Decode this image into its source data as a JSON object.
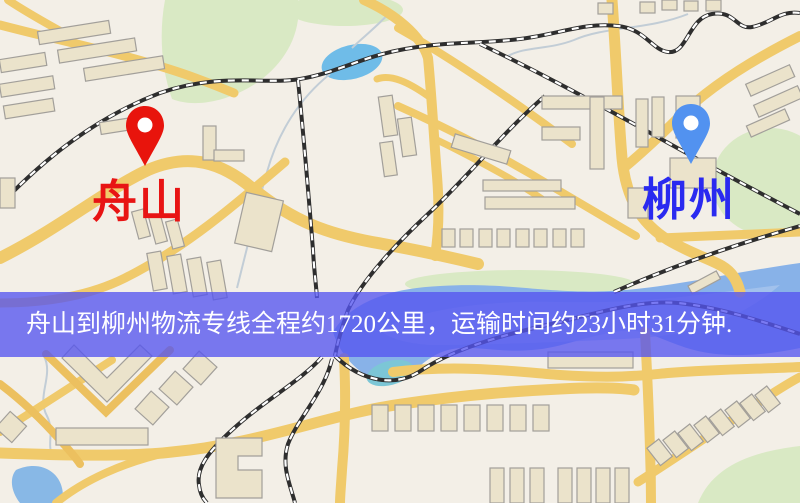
{
  "banner": {
    "text": "舟山到柳州物流专线全程约1720公里，运输时间约23小时31分钟.",
    "background_color": "#5555f0",
    "text_color": "#ffffff"
  },
  "route": {
    "origin": "舟山",
    "destination": "柳州",
    "distance_km": "1720",
    "duration_hours": "23",
    "duration_minutes": "31"
  },
  "markers": {
    "origin": {
      "label": "舟山",
      "icon": "red-location-pin-icon",
      "pin_color": "#e8140c",
      "label_color": "#e81414"
    },
    "destination": {
      "label": "柳州",
      "icon": "blue-location-pin-icon",
      "pin_color": "#5292f0",
      "label_color": "#2a2af0"
    }
  },
  "map": {
    "style": "street-map",
    "colors": {
      "land": "#f3efe7",
      "road": "#f0ca6b",
      "building": "#ebe3cb",
      "park": "#d9e9c4",
      "water": "#88b2e8",
      "lake": "#6fbce8",
      "railway_dark": "#2e2e2e",
      "railway_dash": "#ffffff"
    },
    "features": [
      "roads",
      "railways",
      "buildings",
      "parks",
      "water",
      "streams"
    ]
  }
}
